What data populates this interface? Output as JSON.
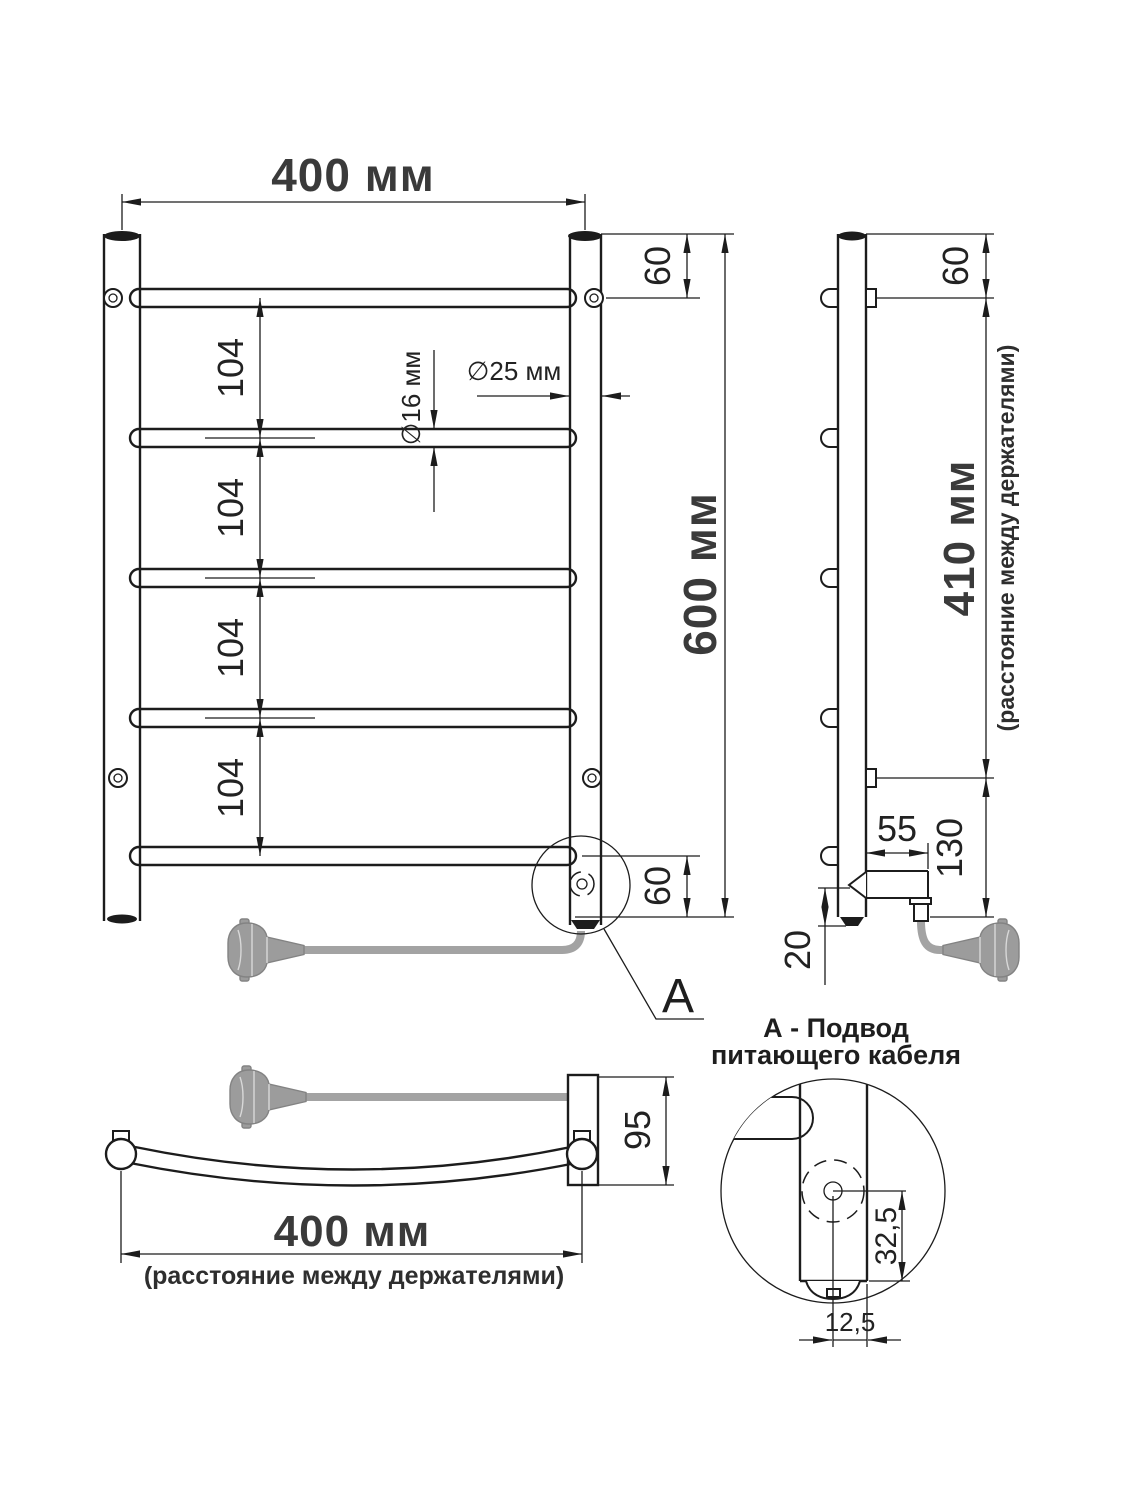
{
  "front_view": {
    "width_label": "400 мм",
    "top_gap_label": "60",
    "rung_gap_labels": [
      "104",
      "104",
      "104",
      "104"
    ],
    "rail_diameter_label": "∅16 мм",
    "post_diameter_label": "∅25 мм",
    "height_label": "600 мм",
    "bottom_gap_label": "60",
    "detail_marker": "A"
  },
  "side_view": {
    "top_gap_label": "60",
    "holder_span_label": "410 мм",
    "holder_span_note": "(расстояние между держателями)",
    "bracket_depth_label": "55",
    "bottom_section_label": "130",
    "cable_gap_label": "20"
  },
  "top_view": {
    "depth_label": "95",
    "holder_span_label": "400 мм",
    "holder_span_note": "(расстояние между держателями)"
  },
  "detail_view": {
    "title_line_1": "А - Подвод",
    "title_line_2": "питающего кабеля",
    "element_offset_label": "32,5",
    "hole_offset_label": "12,5"
  },
  "colors": {
    "line": "#1c1c1c",
    "cable_gray": "#a3a3a3"
  }
}
